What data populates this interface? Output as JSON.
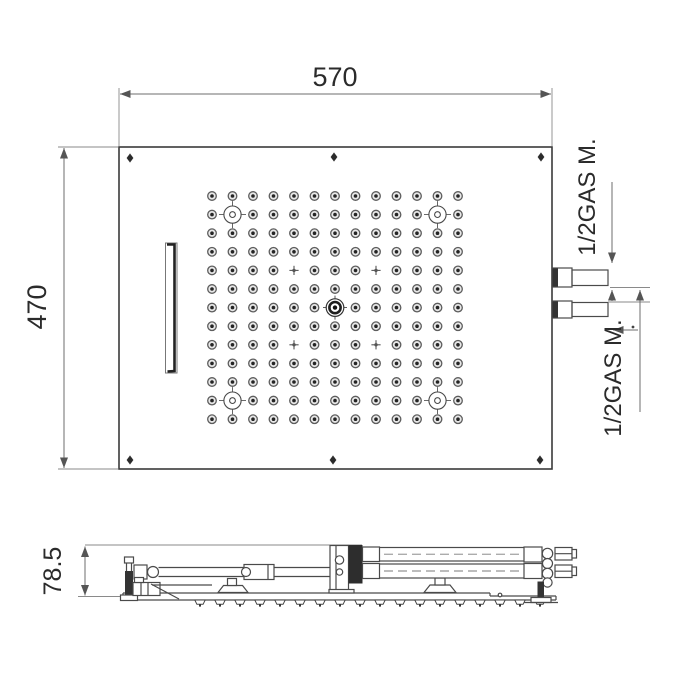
{
  "labels": {
    "top_width": "570",
    "left_height": "470",
    "side_height": "78.5",
    "connection_top": "1/2GAS M.",
    "connection_bottom": "1/2GAS M."
  },
  "nozzle_grid": {
    "cols": 13,
    "rows": 13,
    "x0": 212,
    "y0": 196,
    "dx": 20.5,
    "dy": 18.6,
    "target_positions": [
      [
        1,
        1
      ],
      [
        11,
        1
      ],
      [
        1,
        11
      ],
      [
        11,
        11
      ]
    ],
    "center_position": [
      6,
      6
    ],
    "cross_positions": [
      [
        4,
        4
      ],
      [
        8,
        4
      ],
      [
        4,
        8
      ],
      [
        8,
        8
      ]
    ]
  },
  "screws": [
    [
      130,
      158
    ],
    [
      334,
      157
    ],
    [
      541,
      157
    ],
    [
      130,
      460
    ],
    [
      333,
      460
    ],
    [
      540,
      460
    ]
  ],
  "side_nozzles": {
    "count": 18,
    "x0": 200,
    "dx": 20,
    "y": 600
  },
  "colors": {
    "background": "#ffffff",
    "outline": "#4a4a4a",
    "dimension": "#6e6e6e",
    "text": "#2b2b2b",
    "dark_fill": "#333333"
  }
}
